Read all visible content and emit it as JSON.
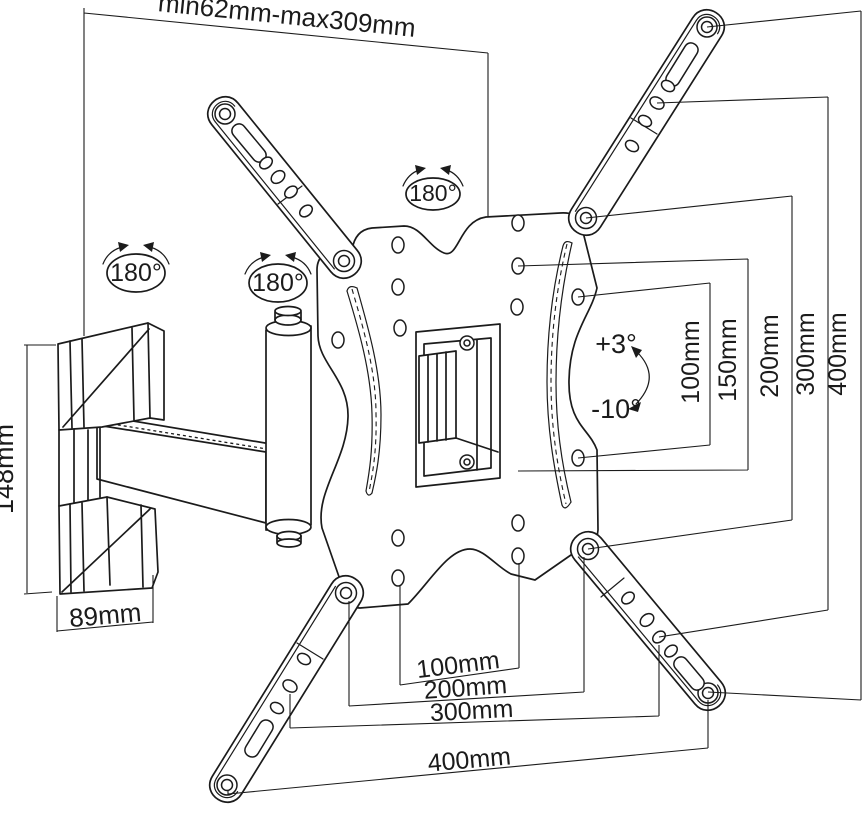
{
  "diagram": {
    "background": "#ffffff",
    "line_color": "#1b1b1b"
  },
  "labels": {
    "extension_range": "min62mm-max309mm",
    "mount_height": "148mm",
    "mount_depth": "89mm",
    "swivel_arm_left": "180°",
    "swivel_arm_mid": "180°",
    "swivel_plate": "180°",
    "tilt_up": "+3°",
    "tilt_down": "-10°"
  },
  "vesa_vertical": [
    "100mm",
    "150mm",
    "200mm",
    "300mm",
    "400mm"
  ],
  "vesa_horizontal": [
    "100mm",
    "200mm",
    "300mm",
    "400mm"
  ]
}
